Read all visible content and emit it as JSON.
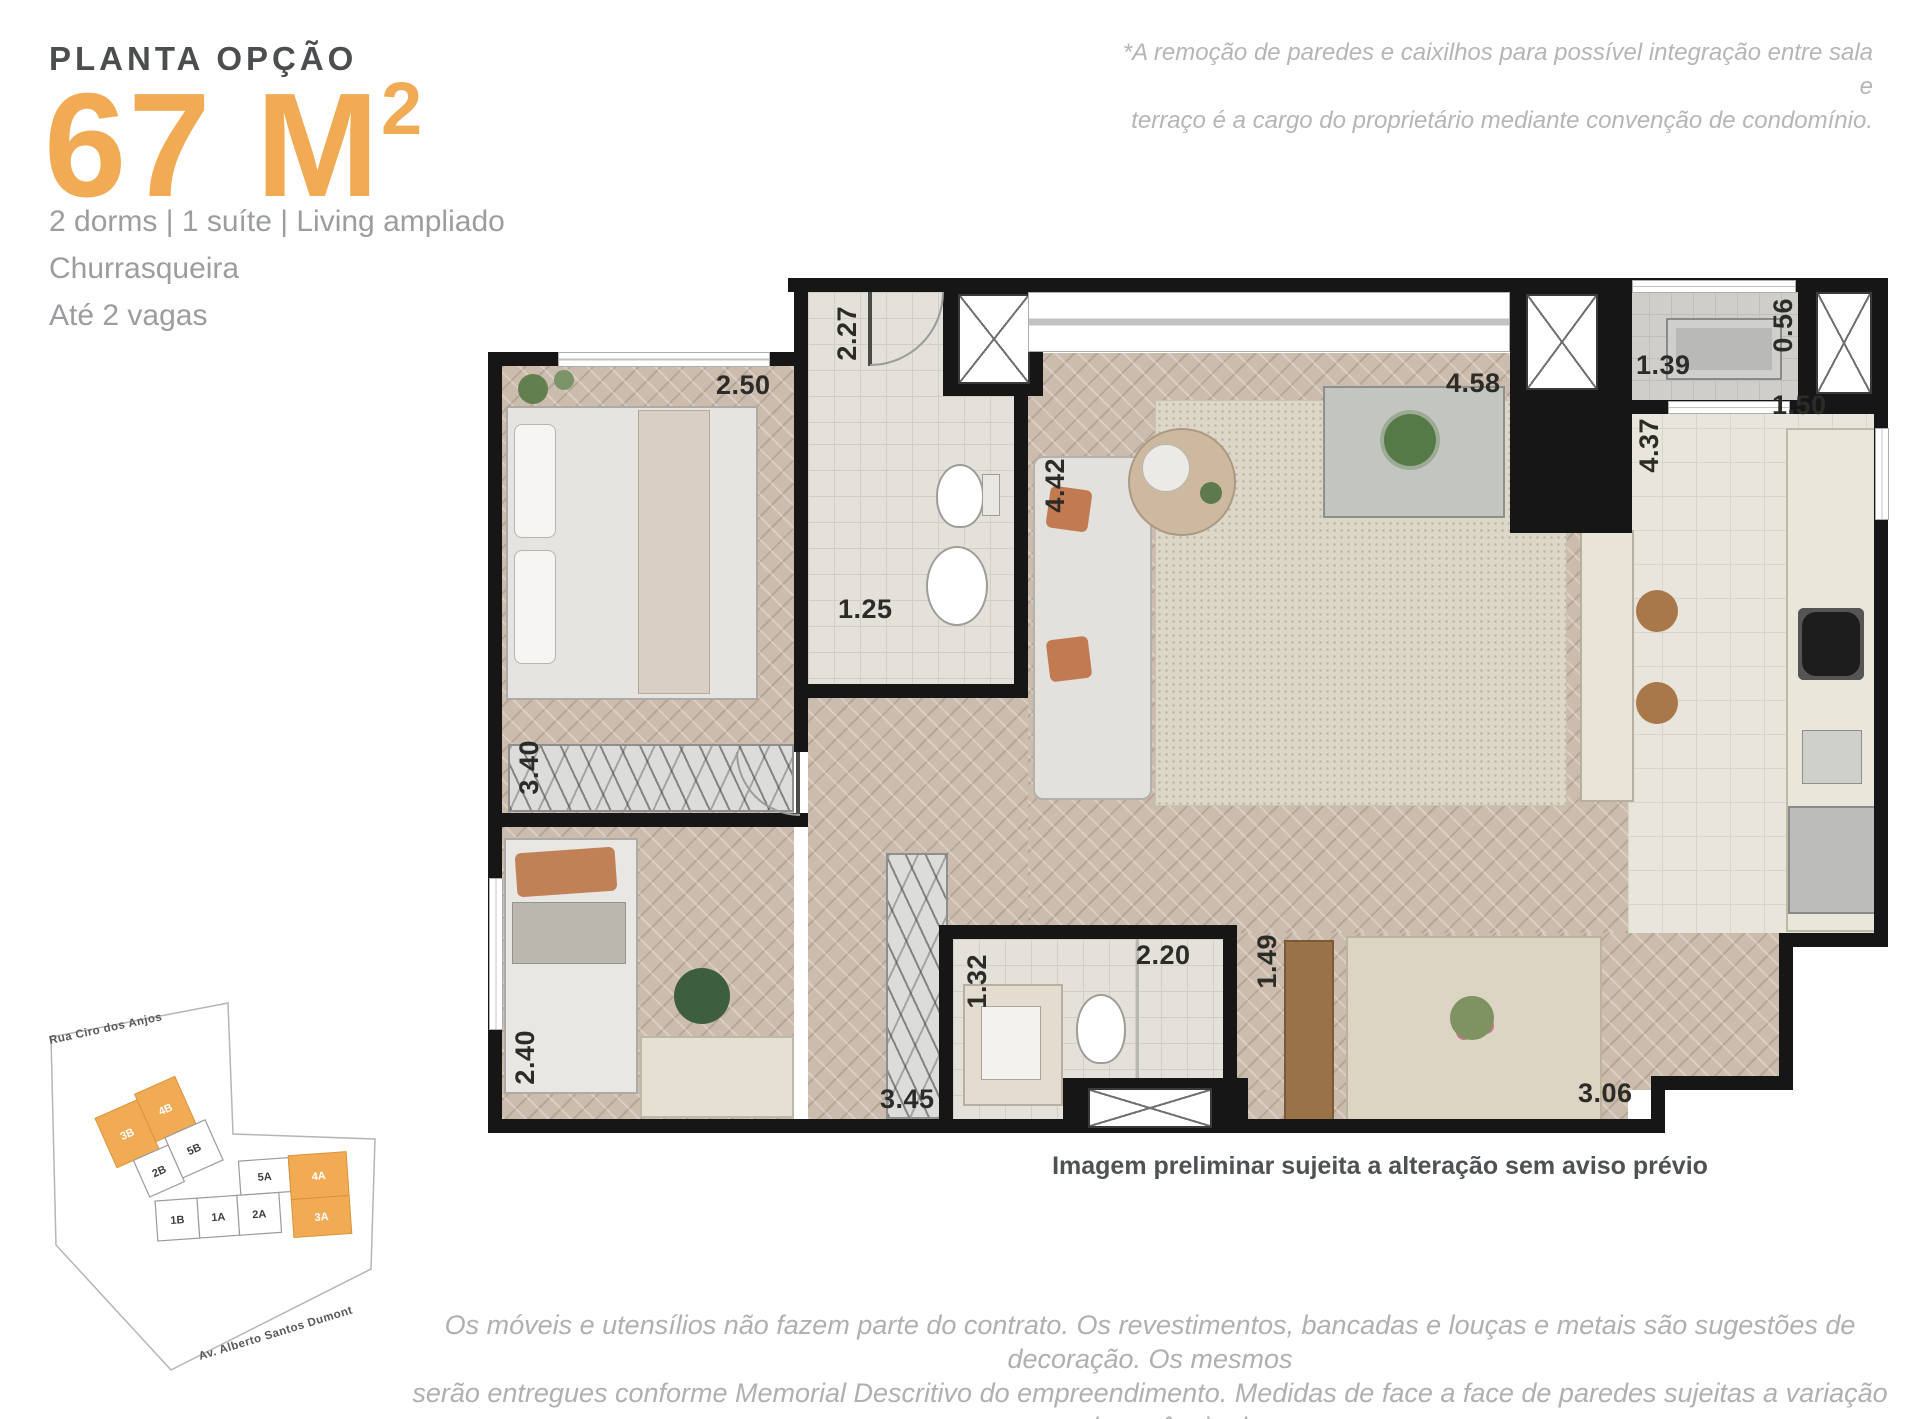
{
  "header": {
    "kicker": "PLANTA OPÇÃO",
    "area_main": "67 M",
    "area_sup": "2",
    "feature_line1": "2 dorms | 1 suíte | Living ampliado",
    "feature_line2": "Churrasqueira",
    "feature_line3": "Até 2 vagas"
  },
  "note_top_right": {
    "line1": "*A remoção de paredes e caixilhos para possível integração entre sala e",
    "line2": "terraço é a cargo do proprietário mediante convenção de condomínio."
  },
  "plan": {
    "caption": "Imagem preliminar sujeita a alteração sem aviso prévio",
    "dims": {
      "entry_depth": "2.27",
      "suite_width": "2.50",
      "suite_bath_width": "1.25",
      "suite_length": "3.40",
      "living_depth": "4.42",
      "grill_wall": "4.58",
      "service_terrace_width": "1.39",
      "service_terrace_depth": "0.56",
      "kitchen_length": "4.37",
      "kitchen_width": "1.50",
      "bedroom2_width": "2.40",
      "closet_length": "3.45",
      "bath2_width": "1.32",
      "bath2_length": "2.20",
      "dining_width": "1.49",
      "living_width": "3.06"
    }
  },
  "keyplan": {
    "street_top": "Rua Ciro dos Anjos",
    "street_bottom": "Av. Alberto Santos Dumont",
    "units": [
      {
        "label": "3B",
        "highlight": true
      },
      {
        "label": "4B",
        "highlight": true
      },
      {
        "label": "2B",
        "highlight": false
      },
      {
        "label": "5B",
        "highlight": false
      },
      {
        "label": "5A",
        "highlight": false
      },
      {
        "label": "1B",
        "highlight": false
      },
      {
        "label": "1A",
        "highlight": false
      },
      {
        "label": "2A",
        "highlight": false
      },
      {
        "label": "4A",
        "highlight": true
      },
      {
        "label": "3A",
        "highlight": true
      }
    ]
  },
  "footer": {
    "line1": "Os móveis e utensílios não fazem parte do contrato. Os revestimentos, bancadas e louças e metais são sugestões de decoração. Os mesmos",
    "line2": "serão entregues conforme Memorial Descritivo do empreendimento. Medidas de face a face de paredes sujeitas a variação em decorrência da",
    "line3": "execução e dos acabamentos a serem utilizados."
  },
  "colors": {
    "accent": "#F2AB55",
    "wall": "#161616",
    "dim_text": "#2b2b28",
    "muted_text": "#9b9da0",
    "disclaimer_text": "#aeb0b2"
  }
}
